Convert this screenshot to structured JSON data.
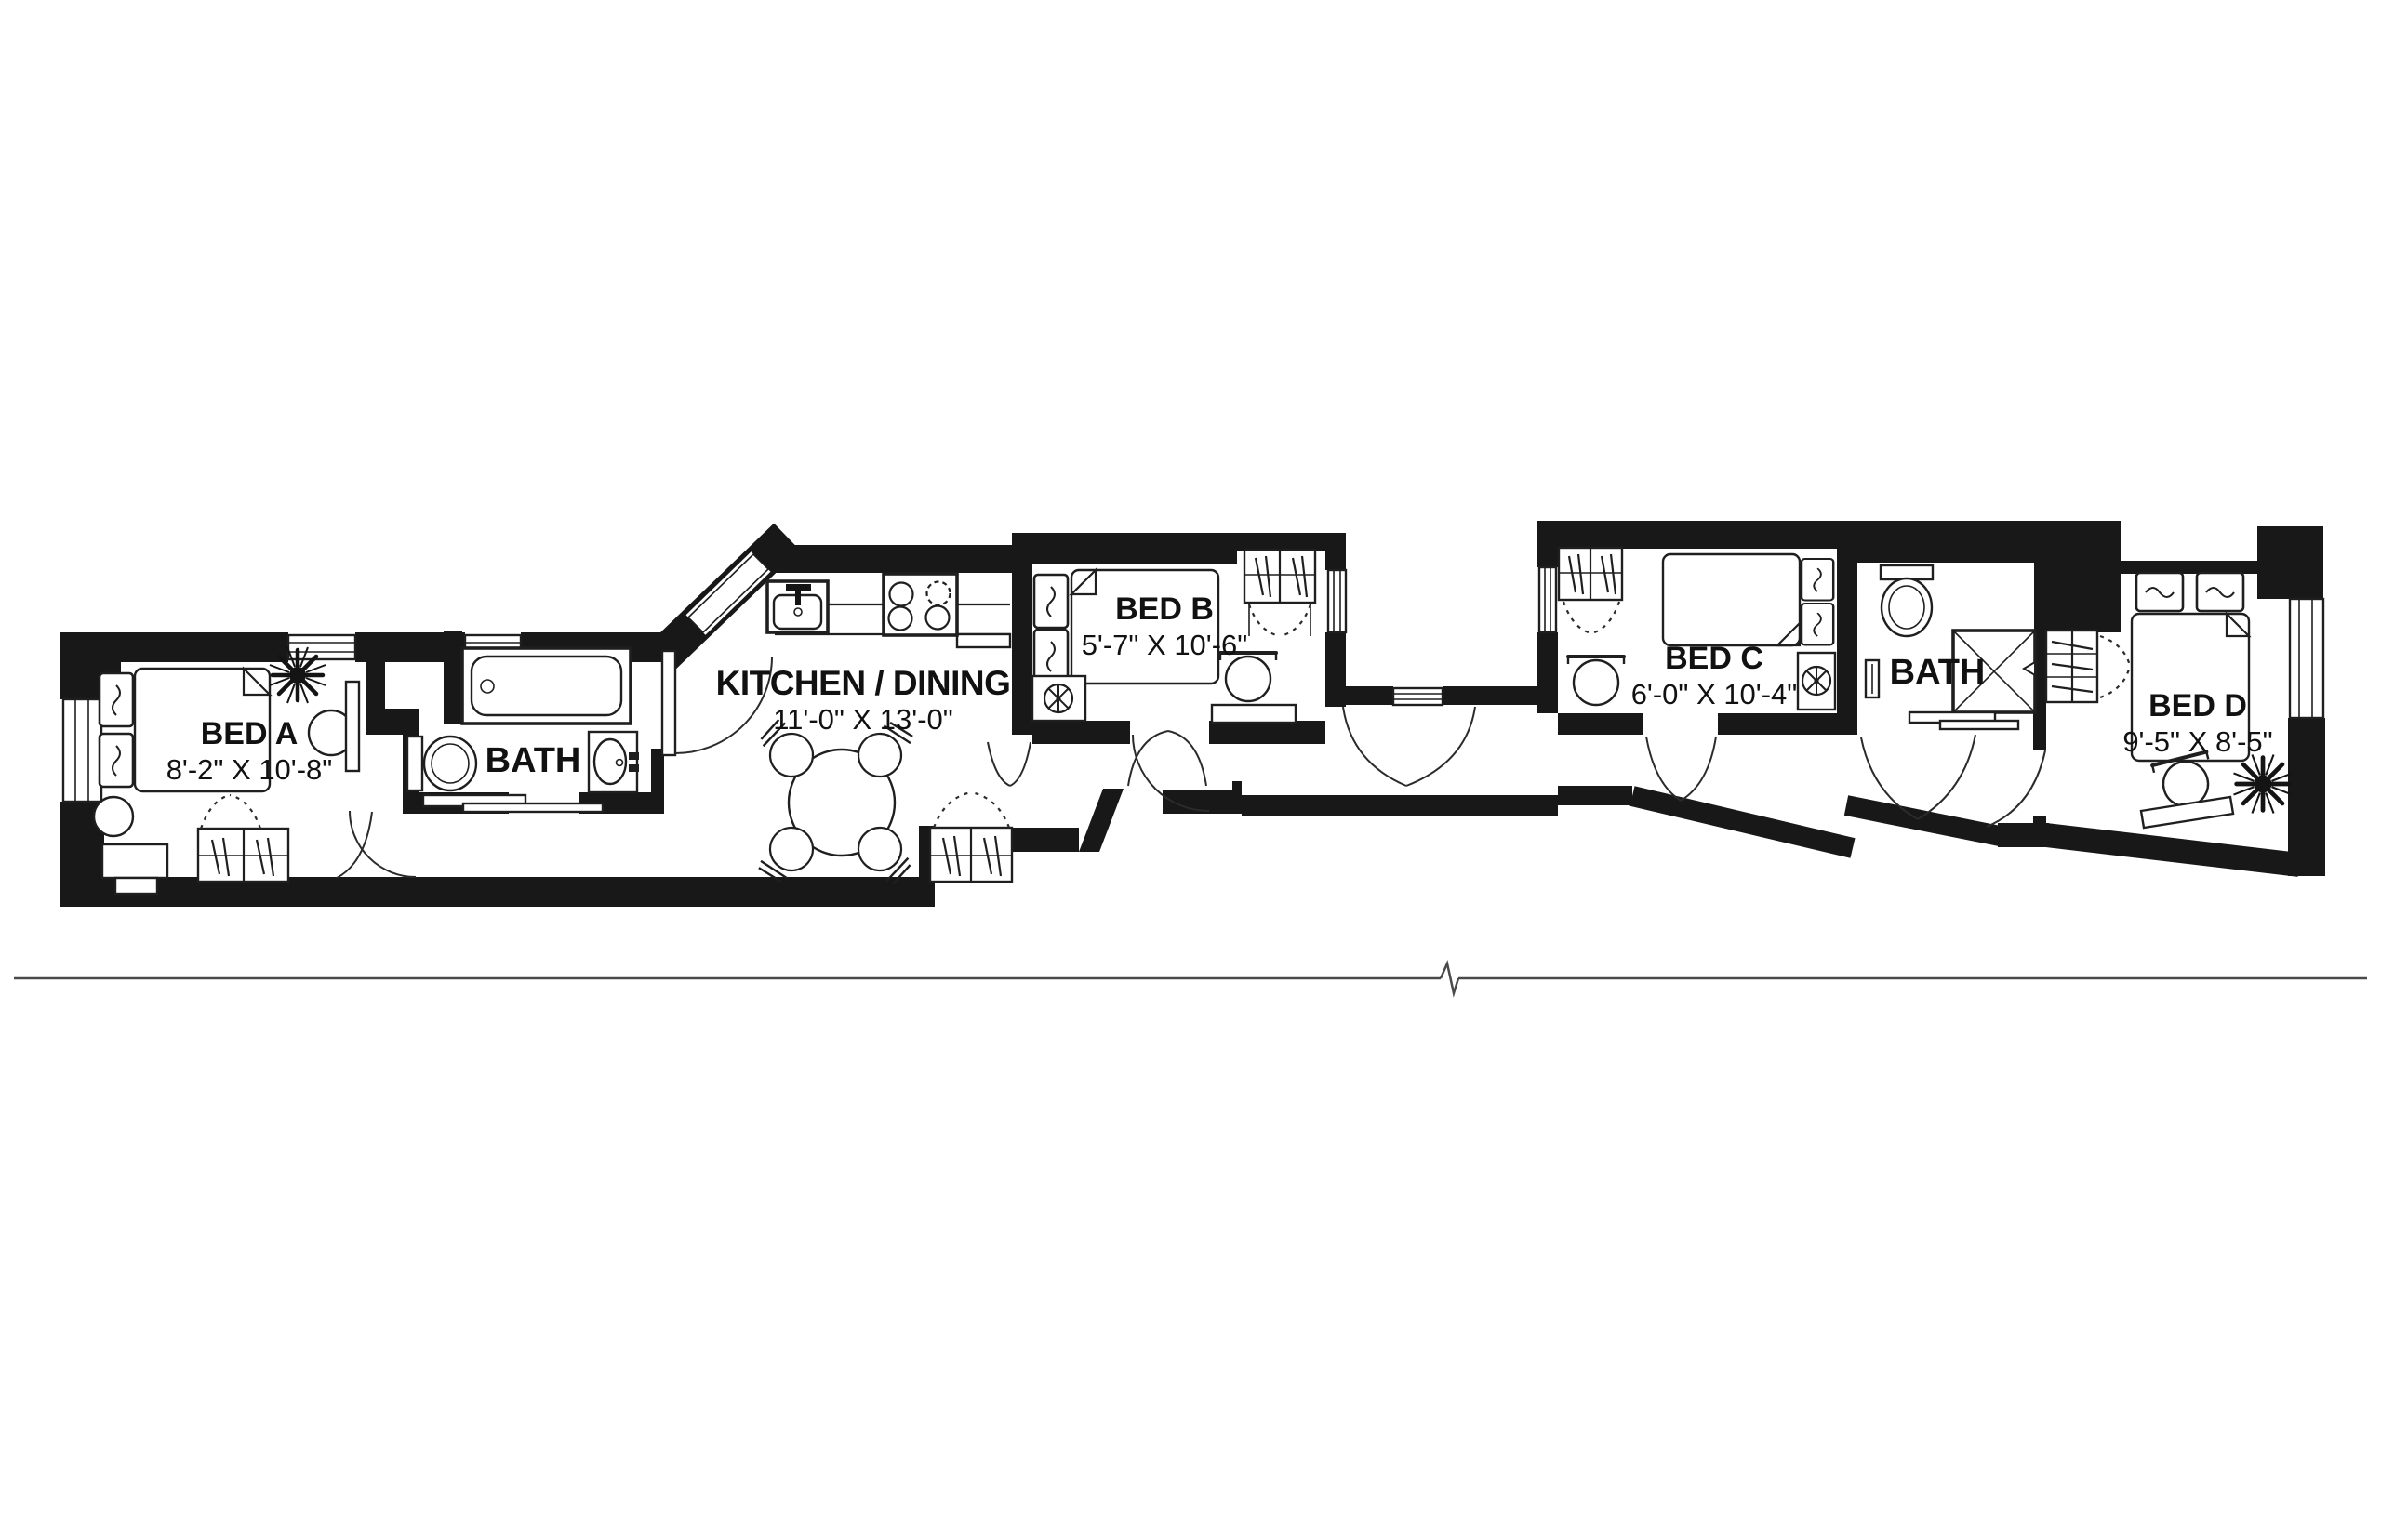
{
  "plan": {
    "type": "apartment-floor-plan",
    "rooms": {
      "bed_a": {
        "name": "BED A",
        "dims": "8'-2\" X 10'-8\""
      },
      "bath_1": {
        "name": "BATH",
        "dims": ""
      },
      "kitchen": {
        "name": "KITCHEN / DINING",
        "dims": "11'-0\" X 13'-0\""
      },
      "bed_b": {
        "name": "BED B",
        "dims": "5'-7\" X 10'-6\""
      },
      "bed_c": {
        "name": "BED C",
        "dims": "6'-0\" X 10'-4\""
      },
      "bath_2": {
        "name": "BATH",
        "dims": ""
      },
      "bed_d": {
        "name": "BED D",
        "dims": "9'-5\" X 8'-5\""
      }
    },
    "colors": {
      "wall": "#181818",
      "line": "#1f1f1f",
      "background": "#ffffff"
    }
  }
}
